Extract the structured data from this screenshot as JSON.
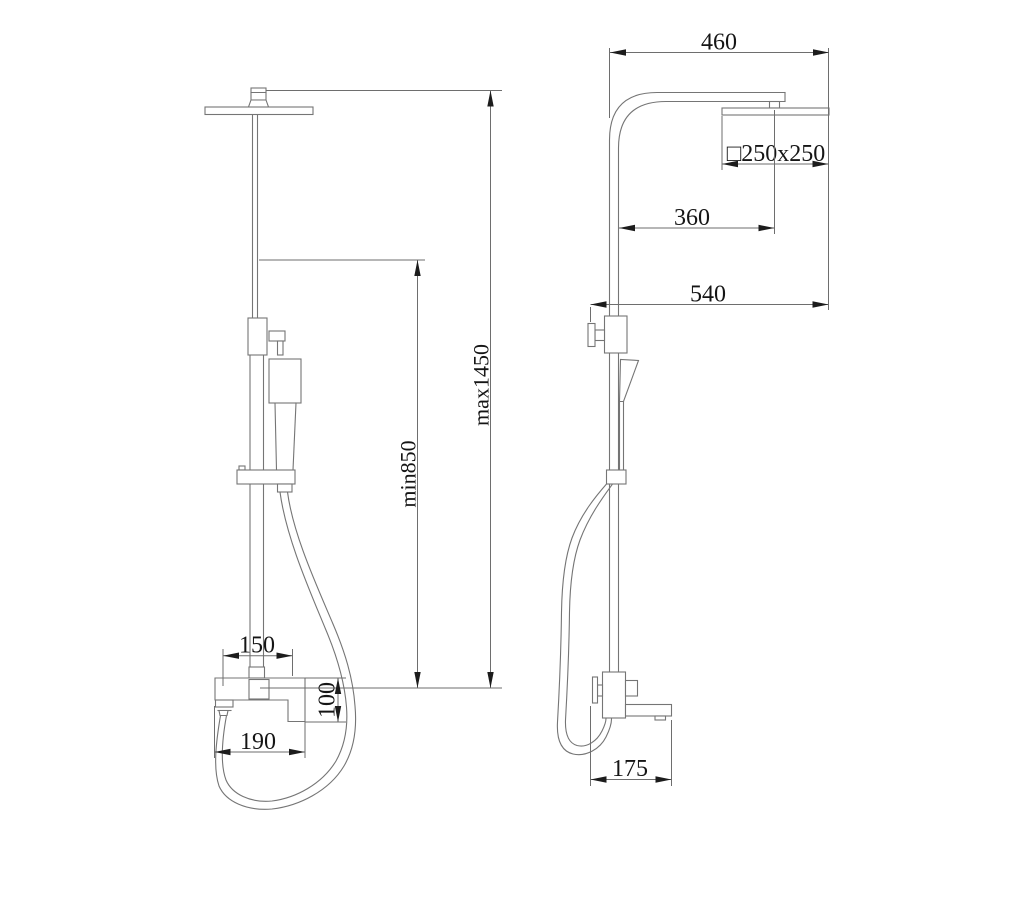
{
  "drawing": {
    "kind": "shower-column-dimension-drawing",
    "front": {
      "dim_overall_height_max": "max1450",
      "dim_overall_height_min": "min850",
      "dim_inlet_spacing": "150",
      "dim_mixer_body_height": "100",
      "dim_mixer_body_width": "190"
    },
    "side": {
      "dim_arm_reach": "460",
      "dim_head_size": "□250x250",
      "dim_head_center_offset": "360",
      "dim_overall_depth": "540",
      "dim_spout_reach": "175"
    },
    "colors": {
      "background": "#ffffff",
      "outline": "#757575",
      "dimension_line": "#6e6e6e",
      "arrow": "#1c1c1c",
      "text": "#151515"
    }
  }
}
